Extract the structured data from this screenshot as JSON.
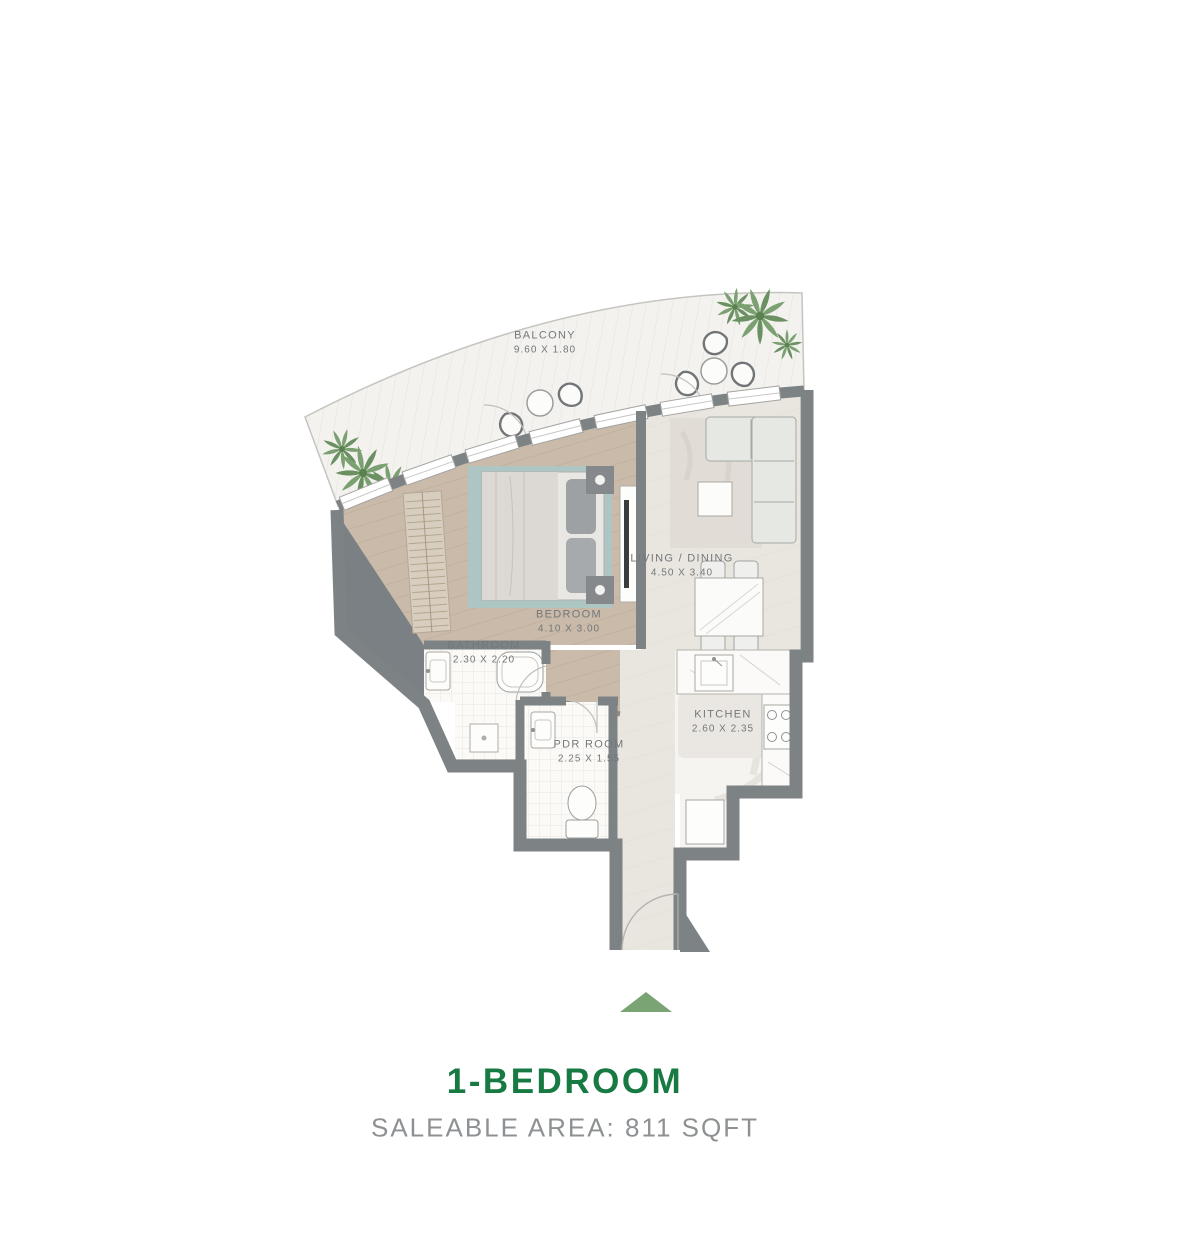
{
  "plan": {
    "rooms": [
      {
        "id": "balcony",
        "name": "BALCONY",
        "dims": "9.60 X 1.80"
      },
      {
        "id": "living_dining",
        "name": "LIVING / DINING",
        "dims": "4.50 X 3.40"
      },
      {
        "id": "bedroom",
        "name": "BEDROOM",
        "dims": "4.10 X 3.00"
      },
      {
        "id": "bathroom",
        "name": "BATHROOM",
        "dims": "2.30 X 2.20"
      },
      {
        "id": "pdr_room",
        "name": "PDR ROOM",
        "dims": "2.25 X 1.55"
      },
      {
        "id": "kitchen",
        "name": "KITCHEN",
        "dims": "2.60 X 2.35"
      }
    ],
    "entrance_marker": "triangle-up"
  },
  "footer": {
    "title": "1-BEDROOM",
    "subtitle": "SALEABLE AREA: 811 SQFT"
  },
  "colors": {
    "accent_green": "#177a42",
    "subtitle_gray": "#8e9193",
    "label_gray": "#74787a",
    "wall_gray": "#7d8285",
    "entrance_marker_green": "#7ba475",
    "wood_floor": "#c9baa9",
    "rug_teal": "#adc5c3"
  }
}
